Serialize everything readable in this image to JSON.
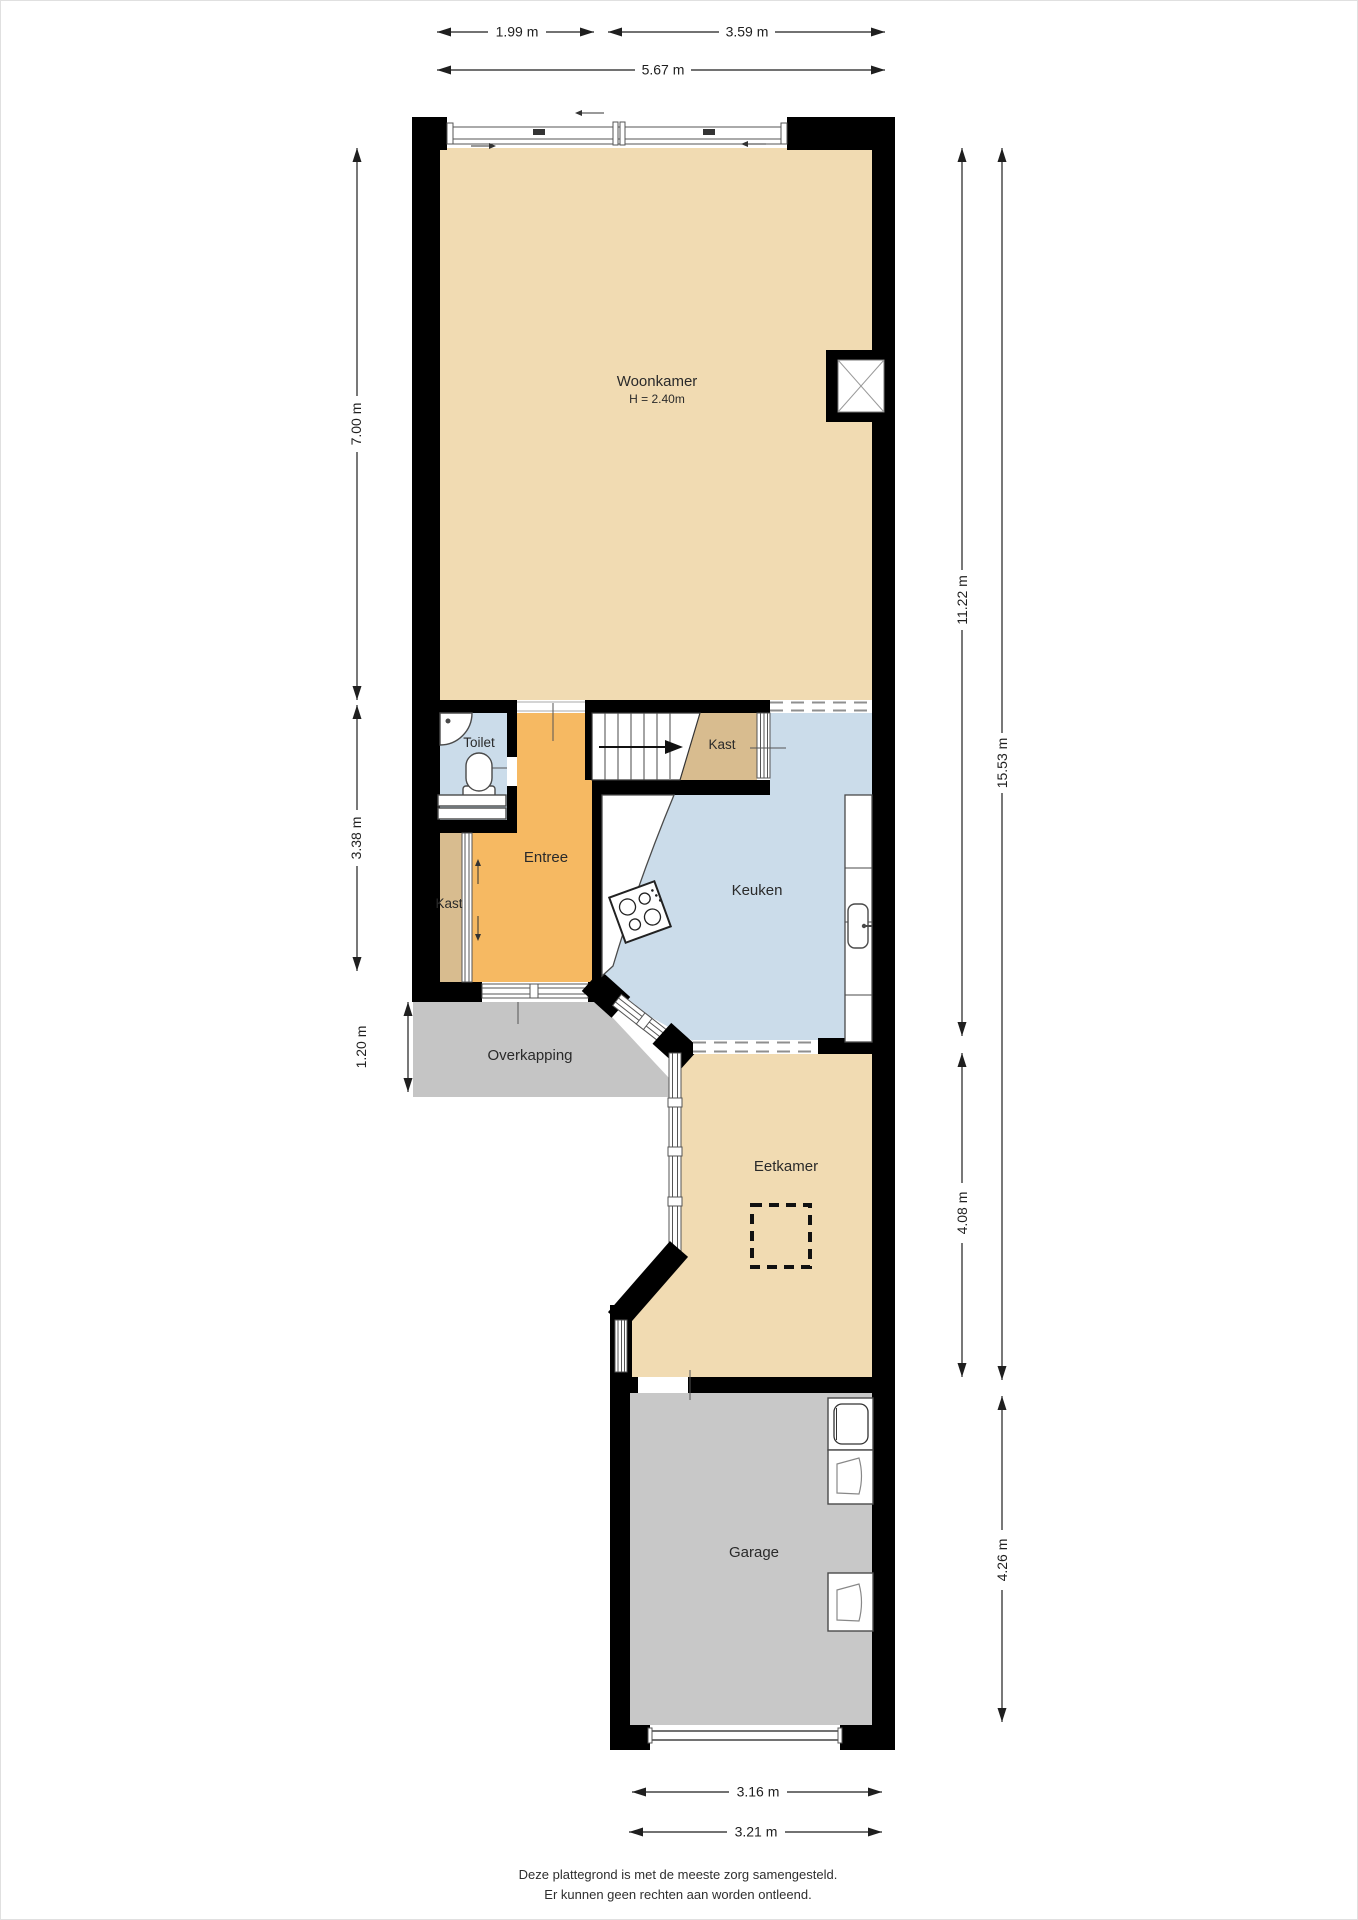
{
  "rooms": {
    "woonkamer": {
      "label": "Woonkamer",
      "height": "H = 2.40m"
    },
    "toilet": {
      "label": "Toilet"
    },
    "kast_hal": {
      "label": "Kast"
    },
    "kast_entree": {
      "label": "Kast"
    },
    "entree": {
      "label": "Entree"
    },
    "keuken": {
      "label": "Keuken"
    },
    "overkapping": {
      "label": "Overkapping"
    },
    "eetkamer": {
      "label": "Eetkamer"
    },
    "garage": {
      "label": "Garage"
    }
  },
  "dimensions": {
    "top": [
      {
        "label": "1.99 m"
      },
      {
        "label": "3.59 m"
      },
      {
        "label": "5.67 m"
      }
    ],
    "left": [
      {
        "label": "7.00 m"
      },
      {
        "label": "3.38 m"
      },
      {
        "label": "1.20 m"
      }
    ],
    "right": [
      {
        "label": "11.22 m"
      },
      {
        "label": "15.53 m"
      },
      {
        "label": "4.08 m"
      },
      {
        "label": "4.26 m"
      }
    ],
    "bottom": [
      {
        "label": "3.16 m"
      },
      {
        "label": "3.21 m"
      }
    ]
  },
  "disclaimer": {
    "line1": "Deze plattegrond is met de meeste zorg samengesteld.",
    "line2": "Er kunnen geen rechten aan worden ontleend."
  },
  "colors": {
    "floor_living": "#F1DBB2",
    "floor_entree": "#F6B962",
    "floor_closet": "#D8BC8F",
    "floor_wet": "#CBDCEA",
    "floor_outdoor": "#C5C5C5",
    "floor_garage": "#C8C8C8",
    "wall": "#000000",
    "dimension_line": "#1f1f1f"
  }
}
